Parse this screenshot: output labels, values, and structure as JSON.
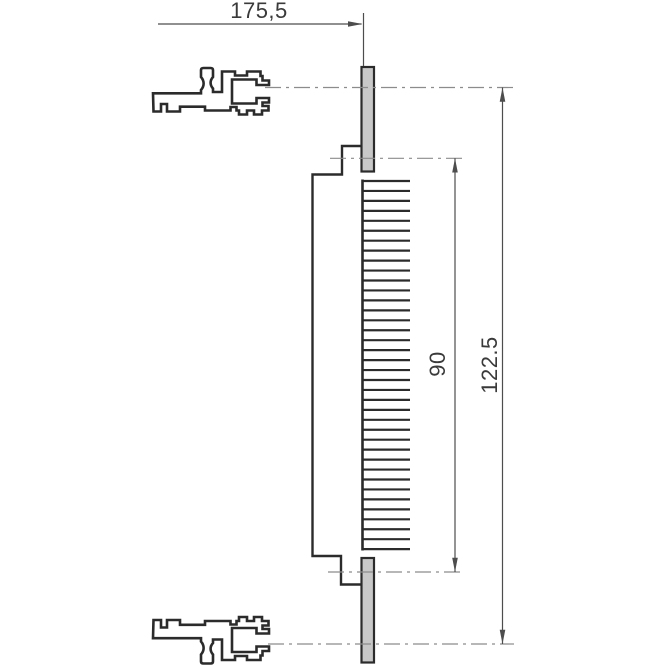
{
  "drawing": {
    "kind": "technical-drawing",
    "background": "#ffffff",
    "line_color": "#2b2b2b",
    "thin_line_color": "#4d4d4d",
    "centerline_color": "#8c8c8c",
    "plate_fill": "#c8c8c8",
    "text_color": "#3a3a3a",
    "dimensions": {
      "horizontal": {
        "label": "175,5"
      },
      "inner_vertical": {
        "label": "90"
      },
      "outer_vertical": {
        "label": "122.5"
      }
    },
    "figure": {
      "teeth": {
        "count": 38,
        "pitch": 9.95,
        "y_start": 181,
        "x_inner": 362,
        "x_outer": 410
      }
    }
  }
}
